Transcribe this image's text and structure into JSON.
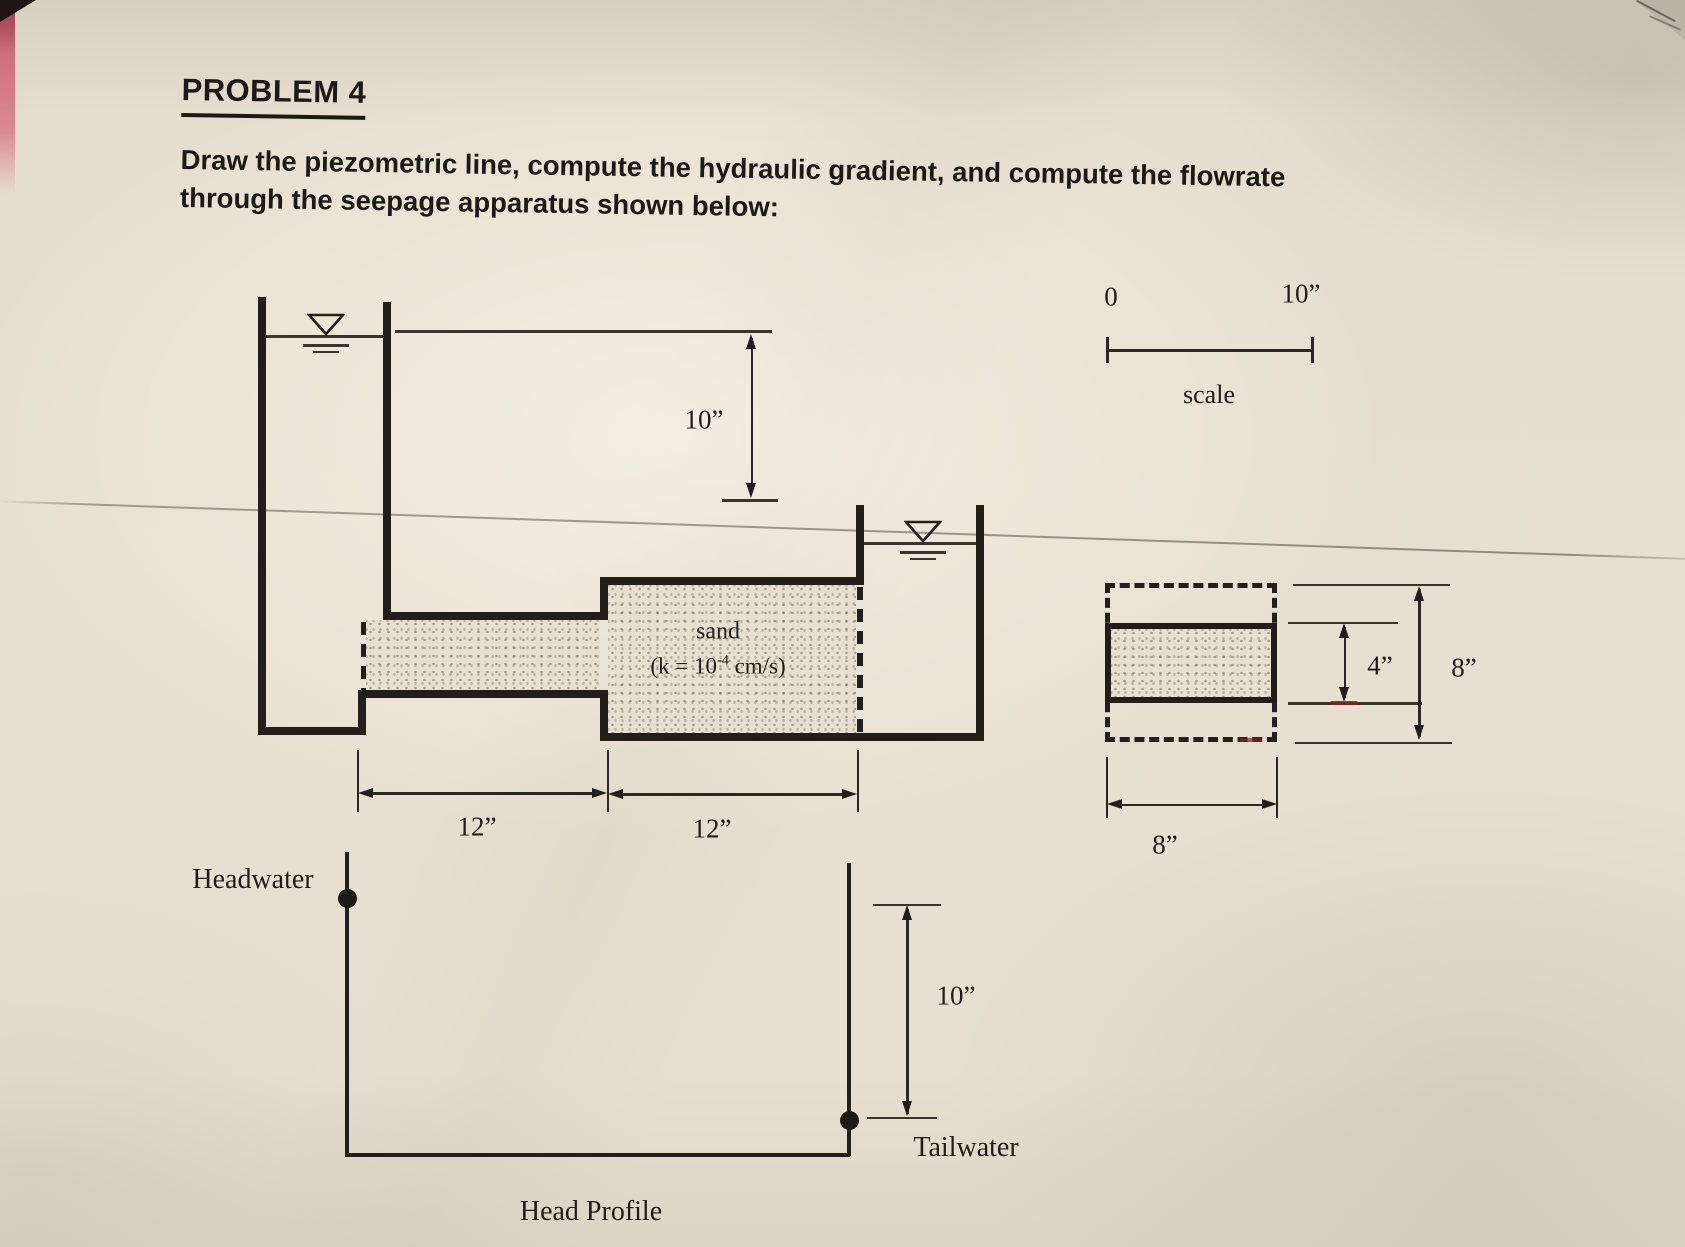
{
  "header": {
    "title": "PROBLEM 4",
    "lines": [
      "Draw the piezometric line, compute the hydraulic gradient, and compute the flowrate",
      "through the seepage apparatus shown below:"
    ]
  },
  "scale_bar": {
    "zero": "0",
    "ten": "10”",
    "caption": "scale"
  },
  "elevation": {
    "head_drop": "10”",
    "sand": "sand",
    "k_prefix": "(k = 10",
    "k_exp": "-4",
    "k_suffix": " cm/s)",
    "len_left": "12”",
    "len_right": "12”"
  },
  "cross_section": {
    "inner_height": "4”",
    "outer_height": "8”",
    "width": "8”"
  },
  "head_profile": {
    "headwater": "Headwater",
    "tailwater": "Tailwater",
    "drop": "10”",
    "caption": "Head Profile"
  },
  "colors": {
    "ink": "#231e19",
    "paper": "#e3dccd",
    "pink_edge": "#cf6f7c"
  }
}
